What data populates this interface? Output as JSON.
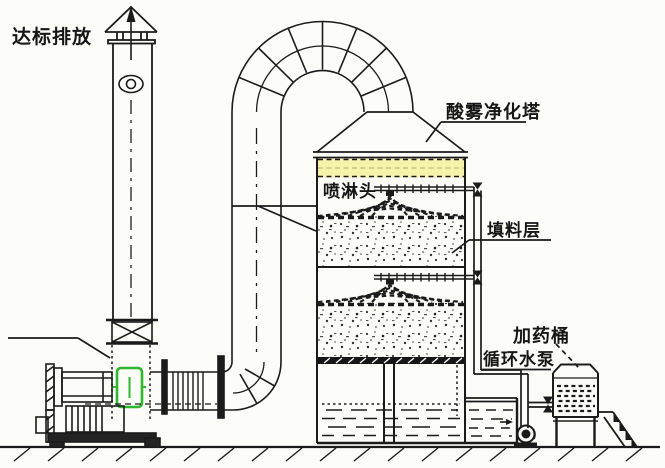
{
  "labels": {
    "discharge": "达标排放",
    "tower": "酸雾净化塔",
    "spray_head": "喷淋头",
    "packing_layer": "填料层",
    "dosing_barrel": "加药桶",
    "circulating_pump": "循环水泵"
  },
  "colors": {
    "line": "#1b1b1b",
    "demister_band_fill": "#f6f3ad",
    "demister_mid_dash": "#c9c377",
    "access_door_green": "#2eb82e",
    "background": "#fcfcf9"
  }
}
